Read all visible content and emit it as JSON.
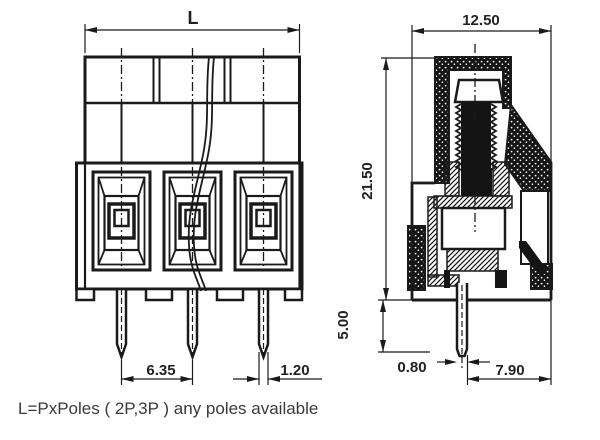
{
  "note": "L=PxPoles ( 2P,3P ) any poles available",
  "front_view": {
    "dim_total_length": "L",
    "dim_pin_pitch": "6.35",
    "dim_pin_width": "1.20"
  },
  "side_view": {
    "dim_depth": "12.50",
    "dim_body_height": "21.50",
    "dim_pin_length": "5.00",
    "dim_pin_thickness": "0.80",
    "dim_pin_to_edge": "7.90"
  },
  "colors": {
    "line": "#1a1a1a",
    "dimension_text": "#222222",
    "note_text": "#3a3a3a",
    "background": "#ffffff"
  }
}
